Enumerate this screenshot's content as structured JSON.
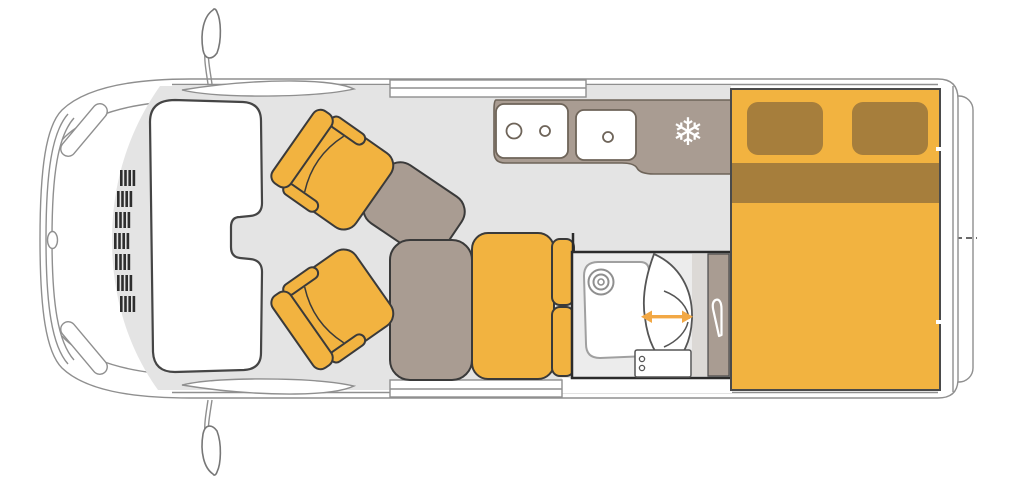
{
  "diagram": {
    "kind": "campervan-floor-plan-top-view"
  },
  "icons": {
    "snowflake_glyph": "❄",
    "snowflake_meaning": "refrigerator",
    "slide_arrow_meaning": "sliding-shower-door-travel",
    "hook_meaning": "wardrobe-clothes-hook"
  },
  "colors": {
    "background": "#ffffff",
    "floor": "#e4e4e4",
    "accent_yellow": "#f2b340",
    "bedding_brown": "#a67e3c",
    "furniture_taupe": "#a99c92",
    "light_trim": "#dcd9d6",
    "outline_dark": "#3a3a3a",
    "outline_body": "#8f8f8f",
    "outline_fixture": "#6e6459",
    "arrow_orange": "#f2a845"
  }
}
